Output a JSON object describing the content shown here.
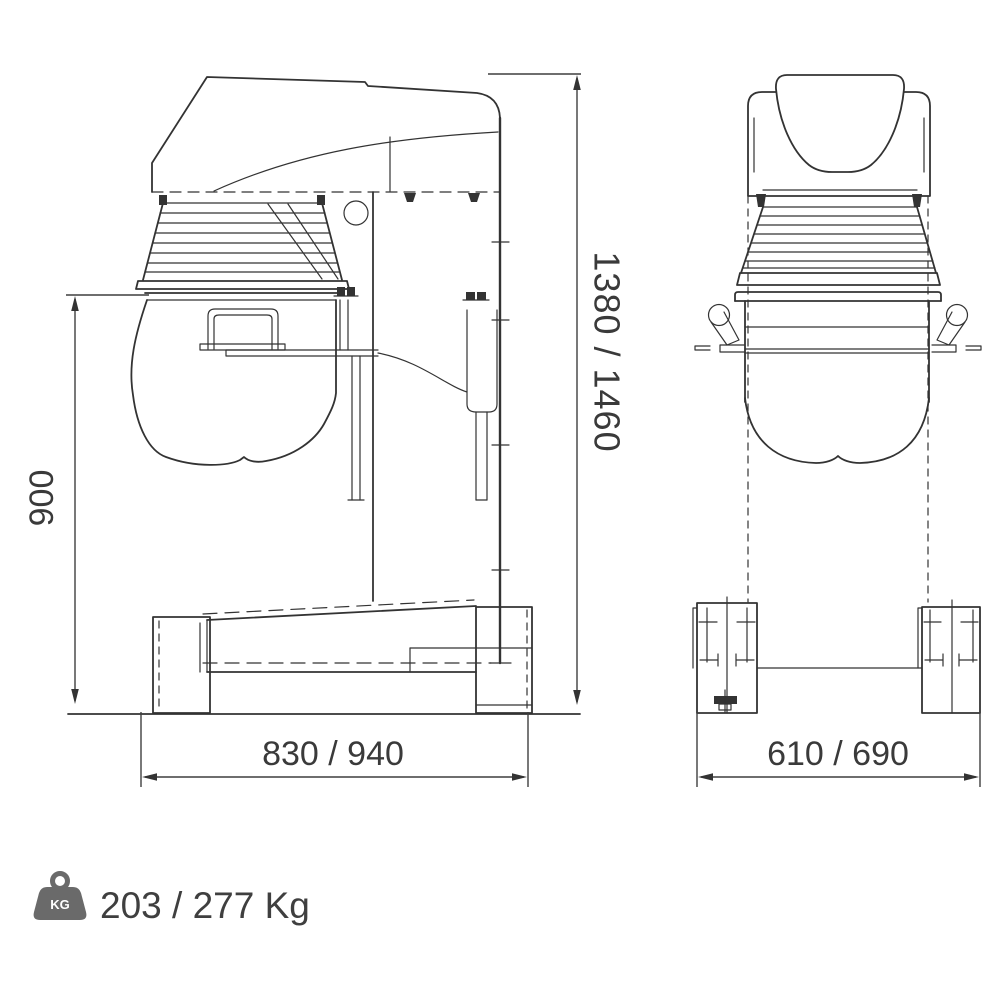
{
  "drawing": {
    "subject": "planetary-mixer-dimension-drawing",
    "views": {
      "left": "side-elevation",
      "right": "front-elevation"
    }
  },
  "dimensions": {
    "overall_height": "1380 / 1460",
    "bowl_height": "900",
    "base_depth": "830 / 940",
    "base_width": "610 / 690"
  },
  "weight": {
    "icon": "kg-weight-icon",
    "icon_label": "KG",
    "value": "203 / 277 Kg"
  },
  "colors": {
    "line": "#333333",
    "dimension_text": "#3a3a3a",
    "weight_icon": "#6a6a6a",
    "background": "#ffffff"
  }
}
